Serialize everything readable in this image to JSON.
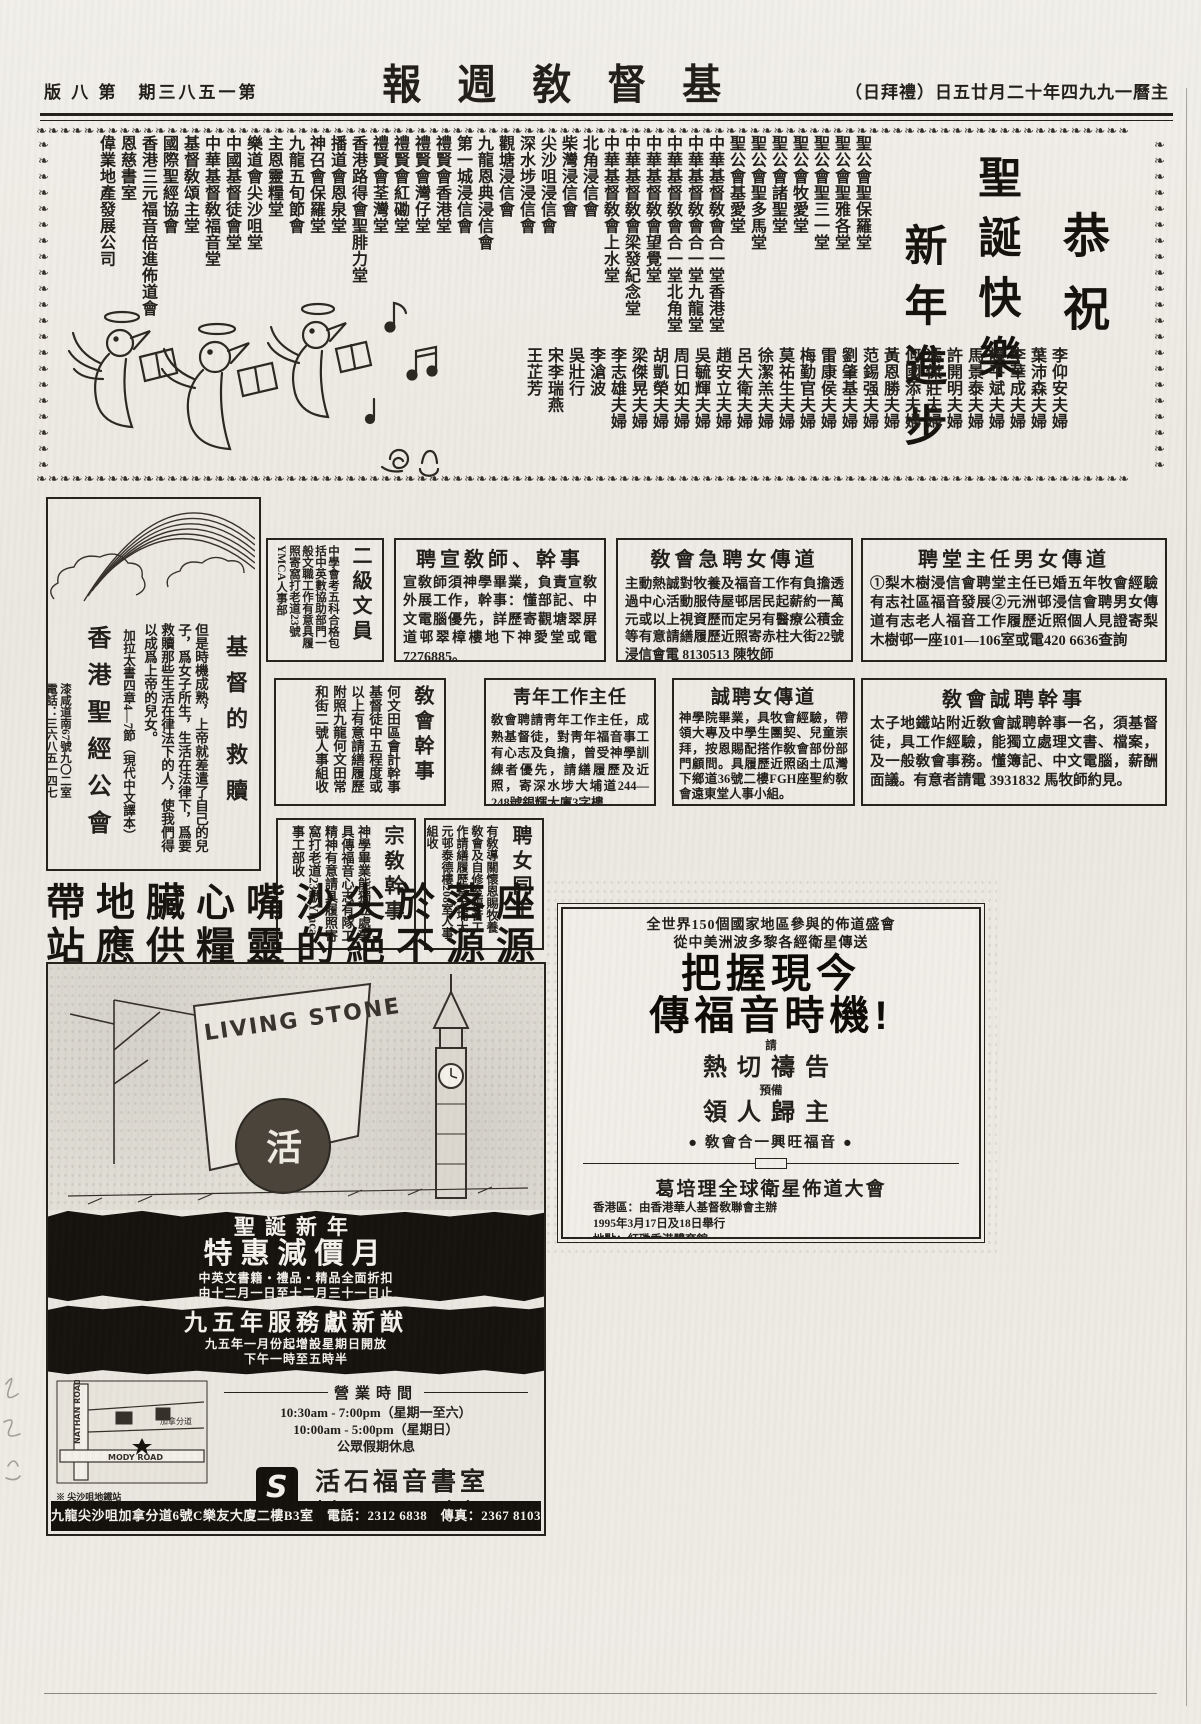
{
  "header": {
    "page_info_display": "版 八 第　期三八五一第",
    "page_info_reading": "第一五八三期 第八版",
    "masthead_display": "報週敎督基",
    "masthead_reading": "基督敎週報",
    "date_display": "（日拜禮）日五廿月二十年四九九一曆主",
    "date_reading": "主曆一九九四年十二月廿五日（禮拜日）"
  },
  "greeting": {
    "border_glyph": "❧",
    "salutation": "恭祝",
    "wish1": "聖誕快樂",
    "wish2": "新年進步",
    "churches": [
      "聖公會聖保羅堂",
      "聖公會聖雅各堂",
      "聖公會聖三一堂",
      "聖公會牧愛堂",
      "聖公會諸聖堂",
      "聖公會聖多馬堂",
      "聖公會基愛堂",
      "中華基督敎會合一堂香港堂",
      "中華基督敎會合一堂九龍堂",
      "中華基督敎會合一堂北角堂",
      "中華基督敎會望覺堂",
      "中華基督敎會梁發紀念堂",
      "中華基督敎會上水堂",
      "北角浸信會",
      "柴灣浸信會",
      "尖沙咀浸信會",
      "深水埗浸信會",
      "觀塘浸信會",
      "九龍恩典浸信會",
      "第一城浸信會",
      "禮賢會香港堂",
      "禮賢會灣仔堂",
      "禮賢會紅磡堂",
      "禮賢會荃灣堂",
      "香港路得會聖腓力堂",
      "播道會恩泉堂",
      "神召會保羅堂",
      "九龍五旬節會",
      "主恩靈糧堂",
      "樂道會尖沙咀堂",
      "中國基督徒會堂",
      "中華基督敎福音堂",
      "基督敎頌主堂",
      "國際聖經協會",
      "香港三元福音倍進佈道會",
      "恩慈書室",
      "偉業地產發展公司"
    ],
    "well_wishers": [
      "李仰安夫婦",
      "葉沛森夫婦",
      "李華成夫婦",
      "譚平斌夫婦",
      "馬景泰夫婦",
      "許開明夫婦",
      "馮傑莊夫婦",
      "何國添夫婦",
      "黃恩勝夫婦",
      "范錫强夫婦",
      "劉肇基夫婦",
      "雷康侯夫婦",
      "梅勤官夫婦",
      "莫祐生夫婦",
      "徐潔羔夫婦",
      "呂大衛夫婦",
      "趙安立夫婦",
      "吳毓輝夫婦",
      "周日如夫婦",
      "胡凱榮夫婦",
      "梁傑晃夫婦",
      "李志雄夫婦",
      "李滄波",
      "吳壯行",
      "宋李瑞燕",
      "王芷芳"
    ]
  },
  "scripture_box": {
    "title": "基督的救贖",
    "body": "但是時機成熟，上帝就差遣了自己的兒子，爲女子所生，生活在法律下，爲要救贖那些生活在律法下的人，使我們得以成爲上帝的兒女。",
    "verse_ref": "加拉太書四章4—7節（現代中文譯本）",
    "org_name": "香港聖經公會",
    "org_address": "漆咸道南67號九〇二室",
    "org_phone": "電話：三六八五一四七"
  },
  "ads": {
    "clerk2": {
      "title": "二級文員",
      "body": "中學會考五科合格包括中英數協助部門一般文職工作有意具履照寄窩打老道23號YMCA人事部"
    },
    "missioner": {
      "title": "聘宣敎師、幹事",
      "body": "宣敎師須神學畢業，負責宣敎外展工作，幹事：懂部記、中文電腦優先，詳歷寄觀塘翠屏道邨翠樟樓地下神愛堂或電7276885。"
    },
    "urgent_female": {
      "title": "敎會急聘女傳道",
      "body": "主動熱誠對牧養及福音工作有負擔透過中心活動服侍屋邨居民起薪約一萬元或以上視資歷而定另有醫療公積金等有意請繕履歷近照寄赤柱大街22號浸信會電 8130513 陳牧師"
    },
    "pastor": {
      "title": "聘堂主任男女傳道",
      "body": "①梨木樹浸信會聘堂主任已婚五年牧會經驗有志社區福音發展②元洲邨浸信會聘男女傳道有志老人福音工作履歷近照個人見證寄梨木樹邨一座101—106室或電420 6636查詢"
    },
    "church_clerk": {
      "title": "敎會幹事",
      "body": "何文田區會計幹事基督徒中五程度或以上有意請繕履歷附照九龍何文田常和街二號人事組收"
    },
    "youth": {
      "title": "靑年工作主任",
      "body": "敎會聘請靑年工作主任，成熟基督徒，對靑年福音事工有心志及負擔，曾受神學訓練者優先，請繕履歷及近照，寄深水埗大埔道244—248號銀輝大廈3字樓"
    },
    "sincere_female": {
      "title": "誠聘女傳道",
      "body": "神學院畢業，具牧會經驗，帶領大專及中學生團契、兒童崇拜，按恩賜配搭作敎會部份部門顧問。具履歷近照函土瓜灣下鄉道36號二樓FGH座聖約敎會遠東堂人事小組。"
    },
    "church_secretary": {
      "title": "敎會誠聘幹事",
      "body": "太子地鐵站附近敎會誠聘幹事一名，須基督徒，具工作經驗，能獨立處理文書、檔案，及一般敎會事務。懂簿記、中文電腦，薪酬面議。有意者請電 3931832 馬牧師約見。"
    },
    "religious_staff": {
      "title": "宗敎幹事",
      "body": "神學畢業能獨立處事具傳福音心志有隊工精神有意請具履照寄窩打老道23號Ymca事工部收"
    },
    "female_coworker": {
      "title": "聘女同工",
      "body": "有敎導關懷恩賜牧養敎會及自修室福音工作請繕履歷寄大埔大元邨泰德樓208室人事組收"
    }
  },
  "headline": {
    "line1_display": "帶地臟心嘴沙尖於落座",
    "line1_reading": "座落於尖沙嘴心臟地帶",
    "line2_display": "站應供糧靈的絕不源源",
    "line2_reading": "源源不絕的靈糧供應站"
  },
  "bookshop_ad": {
    "sign_text": "LIVING STONE",
    "sphere_glyph": "活",
    "promo1_line1": "聖誕新年",
    "promo1_line2": "特惠減價月",
    "promo1_line3": "中英文書籍・禮品・精品全面折扣",
    "promo1_line4": "由十二月一日至十二月三十一日止",
    "promo2_line1": "九五年服務獻新猷",
    "promo2_line2": "九五年一月份起增設星期日開放",
    "promo2_line3": "下午一時至五時半",
    "hours_title": "營業時間",
    "hours_line1": "10:30am - 7:00pm（星期一至六）",
    "hours_line2": "10:00am - 5:00pm（星期日）",
    "hours_line3": "公眾假期休息",
    "logo_glyph": "S",
    "shop_name_zh": "活石福音書室",
    "shop_name_en": "Living Stone Bookshop",
    "address_bar": "九龍尖沙咀加拿分道6號C樂友大廈二樓B3室　電話：2312 6838　傳真：2367 8103",
    "map": {
      "road1": "NATHAN ROAD",
      "road2": "MODY ROAD",
      "street": "加拿分道",
      "station": "※ 尖沙咀地鐵站"
    }
  },
  "crusade_ad": {
    "line1": "全世界150個國家地區參與的佈道盛會",
    "line2": "從中美洲波多黎各經衛星傳送",
    "headline1": "把握現今",
    "headline2": "傳福音時機!",
    "small1": "請",
    "big1": "熱切禱告",
    "small2": "預備",
    "big2": "領人歸主",
    "slogan": "● 敎會合一興旺福音 ●",
    "event_name": "葛培理全球衛星佈道大會",
    "organizer": "香港區：由香港華人基督敎聯會主辦",
    "date_line": "1995年3月17日及18日舉行",
    "venue_line": "地點：紅磡香港體育館",
    "sessions_label": "場次：",
    "sessions": [
      "第一場　3月17日（禮拜五）晚上7:30",
      "第二場　3月18日（禮拜六）下午3:00",
      "第三場　3月18日（禮拜六）晚上7:30"
    ],
    "contact": "聯絡地址：九龍聯合道一百四十號香港華人基督敎聯會大樓",
    "phone": "查詢電話：2337 4171"
  }
}
